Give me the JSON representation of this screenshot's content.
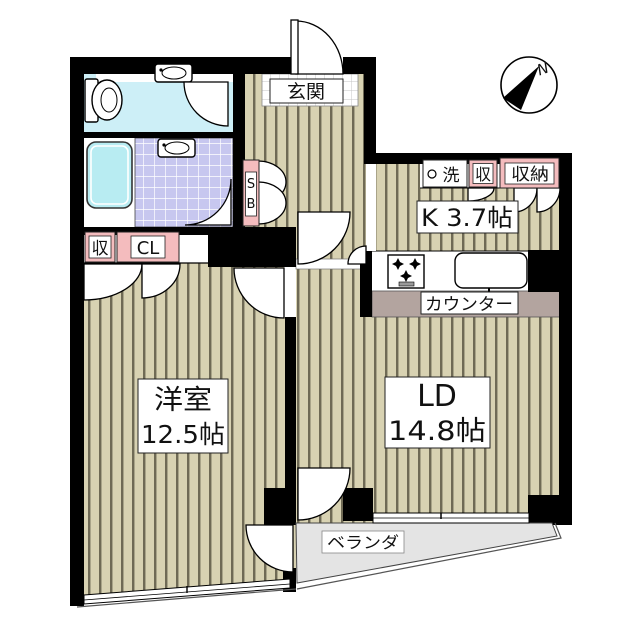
{
  "plan_title": "1LDK apartment floor plan",
  "compass": {
    "north_label": "N"
  },
  "rooms": {
    "entrance": {
      "label": "玄関"
    },
    "kitchen": {
      "label": "K 3.7帖",
      "area_jo": 3.7
    },
    "counter": {
      "label": "カウンター"
    },
    "living_dining": {
      "line1": "LD",
      "line2": "14.8帖",
      "area_jo": 14.8
    },
    "western_room": {
      "line1": "洋室",
      "line2": "12.5帖",
      "area_jo": 12.5
    },
    "veranda": {
      "label": "ベランダ"
    }
  },
  "storage": {
    "shoe_box_line1": "S",
    "shoe_box_line2": "B",
    "washer": "洗",
    "kitchen_storage_small": "収",
    "kitchen_storage": "収納",
    "bedroom_storage": "収",
    "closet": "CL"
  },
  "colors": {
    "wall": "#000000",
    "floor_beige": "#d8d2b2",
    "floor_stripe": "#6f6a55",
    "toilet_floor_cyan": "#cdeff7",
    "bath_tile_lavender": "#c7c7ef",
    "bathtub_cyan": "#b8ecf2",
    "counter_band": "#b3a49f",
    "label_pink": "#f4bcbe",
    "veranda_gray": "#e4e4e4"
  }
}
